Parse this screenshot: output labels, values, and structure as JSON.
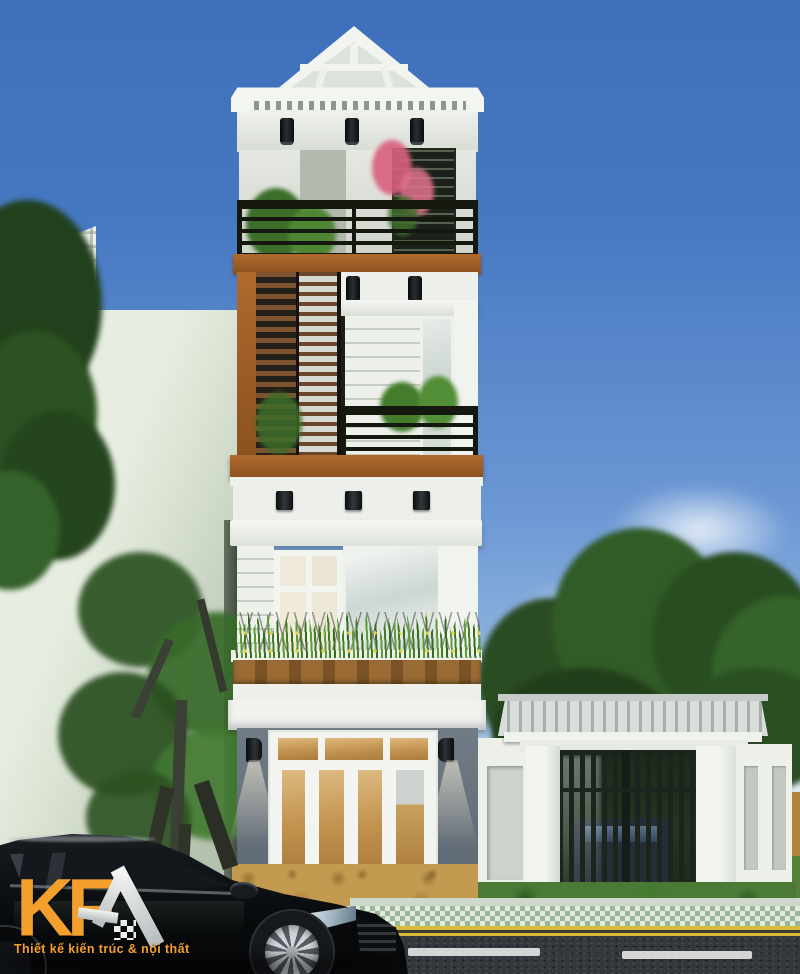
{
  "scene": {
    "title": "KFA modern tube house street elevation render",
    "description": "Photorealistic 3D elevation of a narrow 4-storey modern house: white gabled roof, black slat balcony railings, brown wood louver screens, grass planter box, gray ground floor with amber glass folding doors, tiled-roof side gate in a white fence, trees, and a black sedan parked on the street.",
    "logo": {
      "brand": "KFA",
      "brand_display": "KF",
      "roof_glyph": "a-roof-icon",
      "tagline": "Thiết kế kiến trúc & nội thất"
    },
    "colors": {
      "sky_top": "#3f6fba",
      "sky_horizon": "#d8e6f0",
      "facade_white": "#f1f3ef",
      "accent_wood": "#b06a2c",
      "louver_brown": "#7d5330",
      "railing_black": "#14180f",
      "ground_gray": "#6d7681",
      "door_amber": "#c2924e",
      "gate_green": "#243028",
      "grass_green": "#4f8c2f",
      "road_asphalt": "#34373c",
      "lane_yellow": "#d9bb3c",
      "brand_orange": "#f49f2c",
      "car_black": "#111418"
    }
  }
}
